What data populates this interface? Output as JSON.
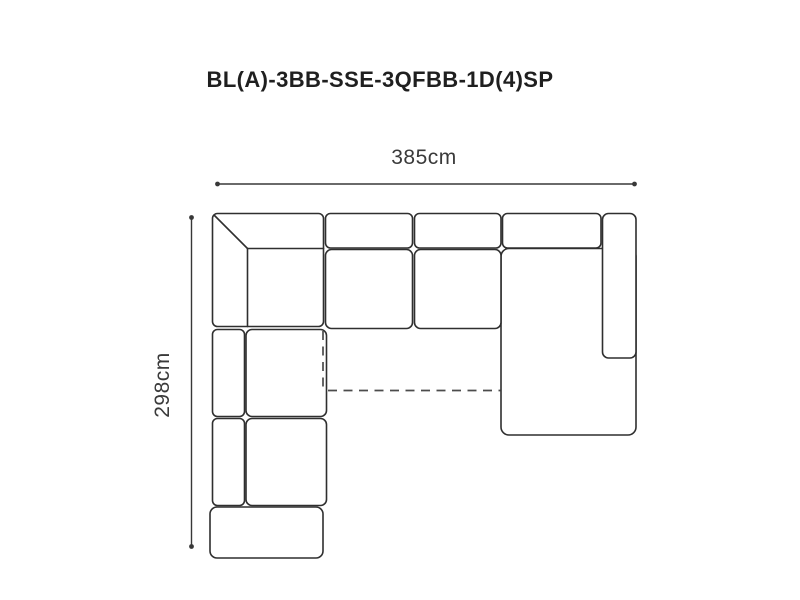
{
  "title": "BL(A)-3BB-SSE-3QFBB-1D(4)SP",
  "dimensions": {
    "width_label": "385cm",
    "depth_label": "298cm"
  },
  "diagram": {
    "kind": "corner-sofa-top-view-schematic",
    "modules": [
      "corner-section",
      "backrest-cushion-1",
      "backrest-cushion-2",
      "backrest-cushion-3",
      "seat-cushion-1",
      "seat-cushion-2",
      "chaise-end-section",
      "right-armrest",
      "left-backrest-1",
      "left-seat-1",
      "left-backrest-2",
      "left-seat-2",
      "open-end-section"
    ],
    "sofa_bed_outline": "dashed"
  },
  "colors": {
    "line": "#2f2f2f",
    "dashed_line": "#4c4c4c",
    "dimension_line": "#383838",
    "title_text": "#1f1f1f",
    "label_text": "#3a3a3a",
    "background": "#ffffff"
  }
}
